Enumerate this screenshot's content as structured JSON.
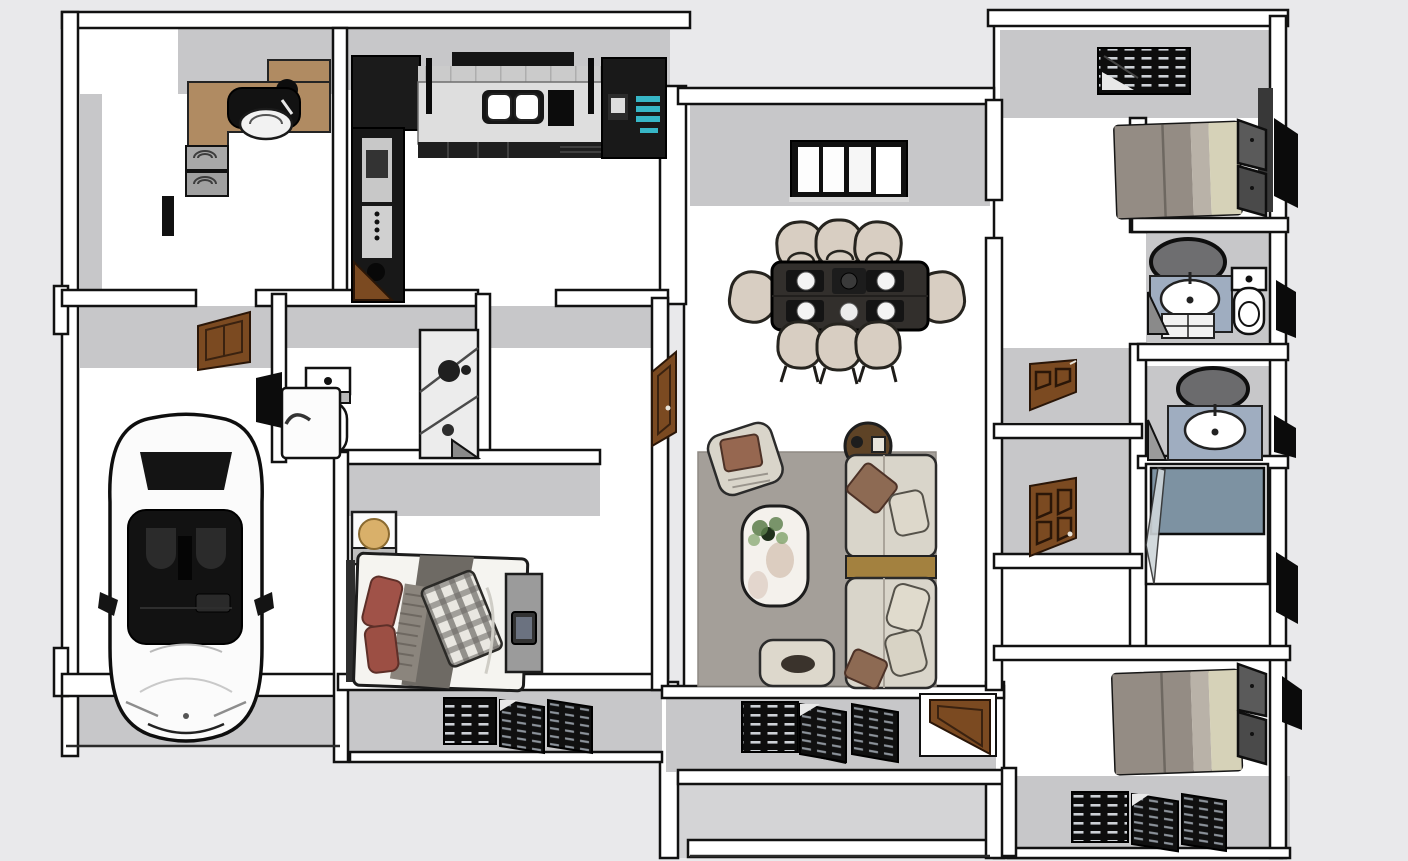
{
  "scene": {
    "type": "3d-floorplan-top-down-render",
    "description": "Bird's-eye 3D cutaway rendering of an apartment: study, kitchen, dining room, living room, hall bathroom, garage with car, three bedrooms, two vanity bathrooms, shower room, patio",
    "visible_text": [],
    "counts": {
      "dining_chairs": 8,
      "place_settings": 6,
      "beds": 3,
      "bathroom_sinks": 2,
      "toilets": 2,
      "louvered_shutter_windows": 4,
      "swing_doors": 6,
      "cars": 1
    }
  },
  "colors": {
    "background": "#e9e9eb",
    "ground": "#d4d4d6",
    "wall_face": "#c7c7c9",
    "wall_top": "#ffffff",
    "outline": "#111111",
    "floor": "#ffffff",
    "wood_door": "#7b4a21",
    "desk_wood": "#b08b62",
    "counter_steel": "#dedede",
    "cabinet_dark": "#1b1b1b",
    "fridge_accent": "#37b6c6",
    "chair_beige": "#d8cec2",
    "table_dark": "#322f2c",
    "rug_gray": "#a49f99",
    "sofa_cream": "#d9d5ca",
    "console_gold": "#a3813f",
    "bed_blanket": "#948c84",
    "bed_sheet_beige": "#d6d2b8",
    "headboard_dark": "#4a4a4a",
    "vanity_blue": "#9fadc0",
    "shower_blue": "#7d92a2",
    "pillow_red": "#a05248",
    "lamp_tan": "#d9b06a",
    "plant_green": "#5a7d4a",
    "shutter_black": "#0d0d0d",
    "car_body": "#fbfbfb",
    "car_glass": "#141414"
  },
  "rooms": [
    {
      "id": "study",
      "objects": [
        "wood-desk",
        "desk-shelf",
        "monitor",
        "office-chair",
        "desk-plant",
        "lounge-chairs"
      ]
    },
    {
      "id": "kitchen",
      "objects": [
        "range-hood",
        "corner-cabinet",
        "appliance-tower",
        "backsplash",
        "steel-counter",
        "double-sink",
        "cooktop",
        "fridge",
        "base-cabinets",
        "corner-door"
      ]
    },
    {
      "id": "dining-room",
      "objects": [
        "window",
        "dining-table",
        "plates",
        "chairs-x8"
      ]
    },
    {
      "id": "living-room",
      "objects": [
        "area-rug",
        "marble-coffee-table",
        "potted-plant",
        "armchair",
        "round-side-table",
        "sectional-sofa",
        "gold-console",
        "ottoman",
        "south-shutters",
        "entry-door"
      ]
    },
    {
      "id": "hall-bathroom",
      "objects": [
        "toilet",
        "shower-enclosure",
        "bathtub"
      ]
    },
    {
      "id": "garage",
      "objects": [
        "car",
        "garage-door",
        "dark-panel"
      ]
    },
    {
      "id": "bedroom-small",
      "objects": [
        "nightstand",
        "lamp",
        "bed-messy",
        "plaid-throw",
        "red-pillows",
        "bench",
        "tablet",
        "south-shutters"
      ]
    },
    {
      "id": "bedroom-master",
      "objects": [
        "north-shutter-window",
        "bed",
        "headboard",
        "side-units"
      ]
    },
    {
      "id": "bathroom-ensuite",
      "objects": [
        "oval-mirror",
        "vanity-sink",
        "drawer-unit",
        "toilet"
      ]
    },
    {
      "id": "bathroom-second",
      "objects": [
        "oval-mirror",
        "vanity-sink"
      ]
    },
    {
      "id": "shower-room",
      "objects": [
        "blue-shower-floor",
        "glass-door"
      ]
    },
    {
      "id": "bedroom-guest",
      "objects": [
        "bed",
        "headboard",
        "south-shutters"
      ]
    },
    {
      "id": "patio",
      "objects": [
        "ground",
        "parapet-wall"
      ]
    }
  ]
}
